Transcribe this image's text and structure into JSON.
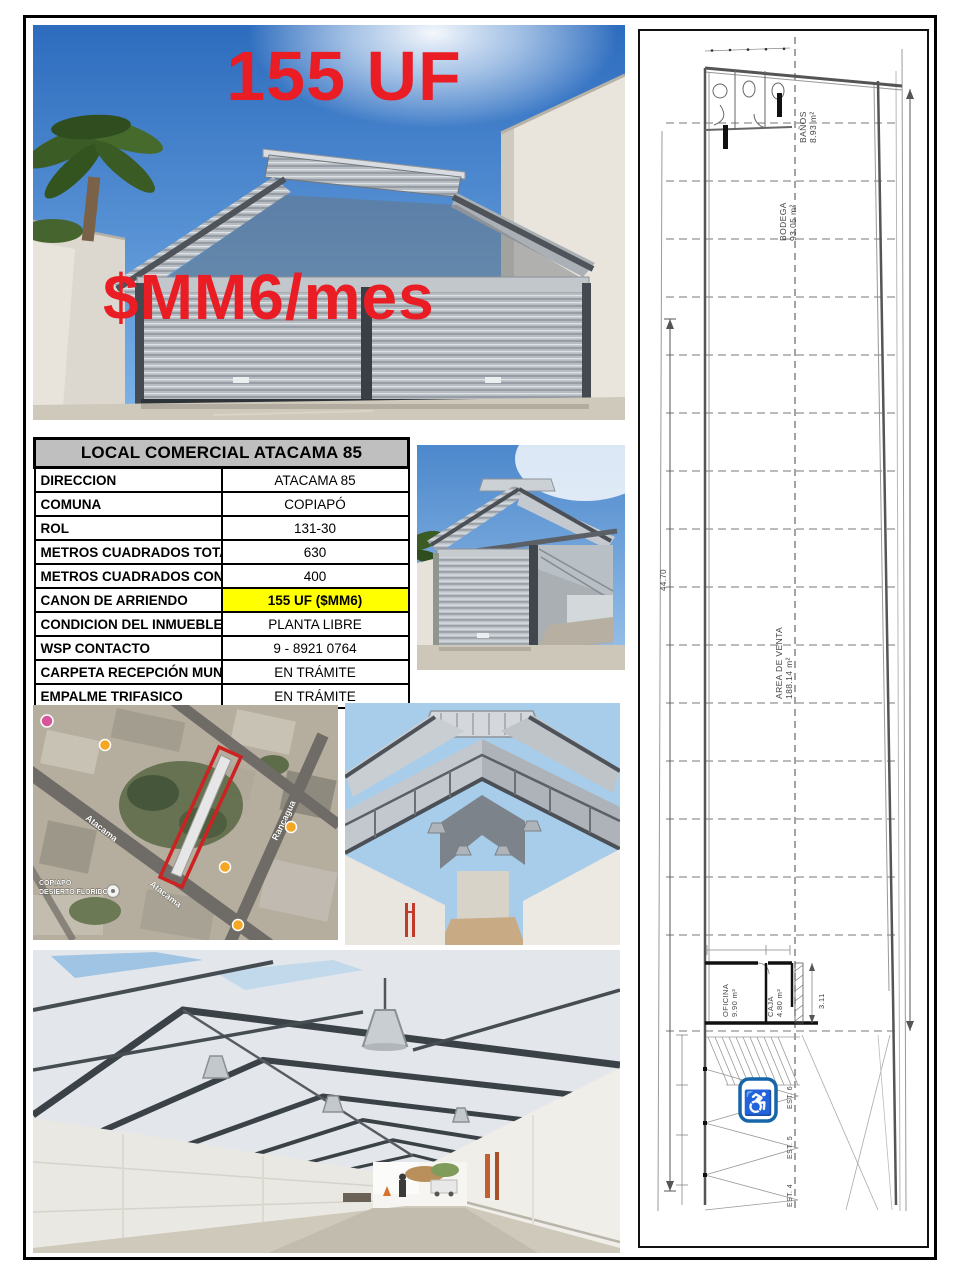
{
  "listing": {
    "price_uf": "155 UF",
    "price_monthly": "$MM6/mes"
  },
  "table": {
    "title": "LOCAL COMERCIAL ATACAMA 85",
    "rows": [
      {
        "label": "DIRECCION",
        "value": "ATACAMA 85"
      },
      {
        "label": "COMUNA",
        "value": "COPIAPÓ"
      },
      {
        "label": "ROL",
        "value": "131-30"
      },
      {
        "label": "METROS CUADRADOS TOTALES",
        "value": "630"
      },
      {
        "label": "METROS CUADRADOS CONSTRUIDOS",
        "value": "400"
      },
      {
        "label": "CANON DE ARRIENDO",
        "value": "155 UF ($MM6)"
      },
      {
        "label": "CONDICION DEL INMUEBLE",
        "value": "PLANTA LIBRE"
      },
      {
        "label": "WSP CONTACTO",
        "value": "9 - 8921 0764"
      },
      {
        "label": "CARPETA RECEPCIÓN MUNICIPAL",
        "value": "EN TRÁMITE"
      },
      {
        "label": "EMPALME TRIFASICO",
        "value": "EN TRÁMITE"
      }
    ]
  },
  "map": {
    "street_atacama": "Atacama",
    "street_rancagua": "Rancagua",
    "poi_line1": "COPIAPO",
    "poi_line2": "DESIERTO FLORIDO"
  },
  "floorplan": {
    "banos_name": "BAÑOS",
    "banos_area": "8.93 m²",
    "bodega_name": "BODEGA",
    "bodega_area": "93.05 m²",
    "venta_name": "AREA DE VENTA",
    "venta_area": "188.14 m²",
    "oficina_name": "OFICINA",
    "oficina_area": "9.90 m²",
    "caja_name": "CAJA",
    "caja_area": "4.80 m²",
    "dim_total": "44.70",
    "dim_rooms": "3.11",
    "est_top": "EST. 6",
    "est_mid": "EST. 5",
    "est_bottom": "EST. 4"
  },
  "colors": {
    "accent_red": "#ea1c24",
    "highlight_yellow": "#ffff00",
    "header_gray": "#bfbfbf",
    "plan_blue": "#1565a8"
  }
}
